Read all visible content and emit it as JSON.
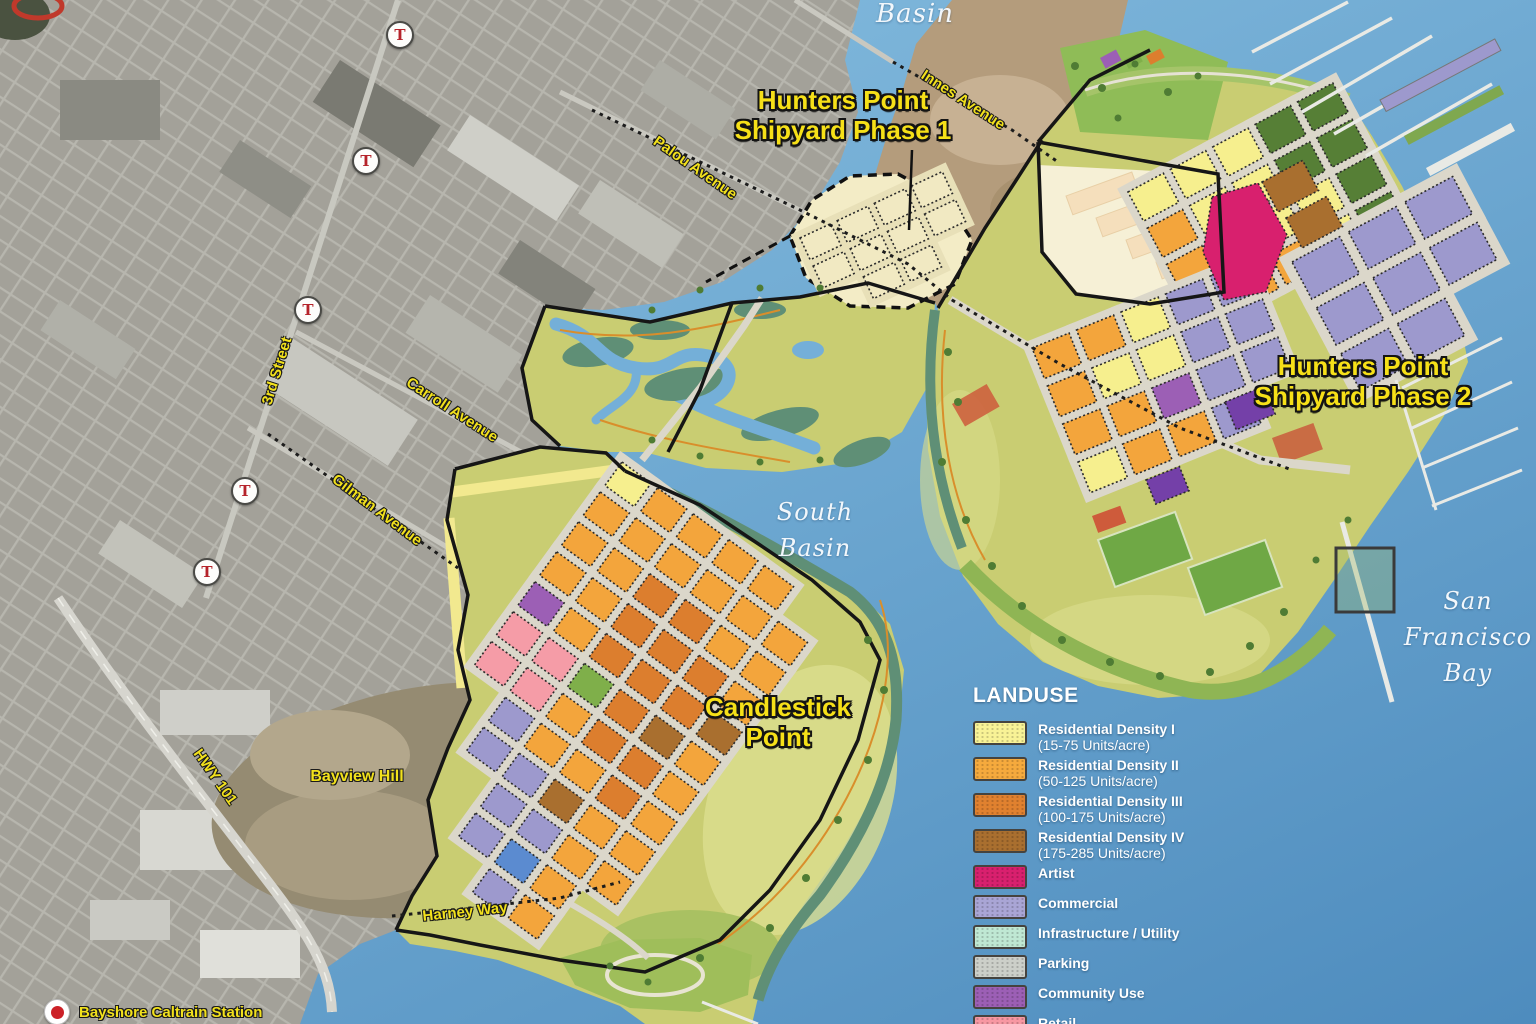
{
  "map": {
    "region_titles": {
      "phase1_line1": "Hunters Point",
      "phase1_line2": "Shipyard Phase 1",
      "phase2_line1": "Hunters Point",
      "phase2_line2": "Shipyard Phase 2",
      "candlestick_line1": "Candlestick",
      "candlestick_line2": "Point"
    },
    "water_labels": {
      "basin_top": "Basin",
      "south_basin_line1": "South",
      "south_basin_line2": "Basin",
      "sf_bay_line1": "San",
      "sf_bay_line2": "Francisco",
      "sf_bay_line3": "Bay"
    },
    "street_labels": {
      "innes": "Innes Avenue",
      "palou": "Palou Avenue",
      "carroll": "Carroll Avenue",
      "third": "3rd Street",
      "gilman": "Gilman Avenue",
      "hwy101": "HWY 101",
      "harney": "Harney Way"
    },
    "place_labels": {
      "bayview_hill": "Bayview Hill",
      "bayshore_station": "Bayshore Caltrain Station"
    },
    "transit_marker_letter": "T"
  },
  "legend": {
    "title": "LANDUSE",
    "items": [
      {
        "label": "Residential Density I",
        "sublabel": "(15-75 Units/acre)",
        "color": "#F8F296"
      },
      {
        "label": "Residential Density II",
        "sublabel": "(50-125 Units/acre)",
        "color": "#F5AA3D"
      },
      {
        "label": "Residential Density III",
        "sublabel": "(100-175 Units/acre)",
        "color": "#E0812F"
      },
      {
        "label": "Residential Density IV",
        "sublabel": "(175-285 Units/acre)",
        "color": "#A96F2F"
      },
      {
        "label": "Artist",
        "color": "#D8206E"
      },
      {
        "label": "Commercial",
        "color": "#A9A5D5"
      },
      {
        "label": "Infrastructure / Utility",
        "color": "#BFE8D3"
      },
      {
        "label": "Parking",
        "color": "#CCCFC9"
      },
      {
        "label": "Community Use",
        "color": "#9C5FB5"
      },
      {
        "label": "Retail",
        "color": "#F797A2"
      },
      {
        "label": "",
        "color": "#6B74B8"
      }
    ]
  },
  "colors": {
    "water1": "#8AC1E2",
    "water2": "#4E8CBE",
    "satellite": "#A3A199",
    "satellite_line": "#CBCAC2",
    "dirt": "#B49C7C",
    "park": "#C9CD72",
    "park_light": "#DADD8C",
    "lawn": "#8FBC57",
    "marsh": "#5F8F76",
    "channel": "#74AFD8",
    "road": "#DBD7CA",
    "boundary": "#161616",
    "cream": "#F6F0D6",
    "peach": "#F5DFBC",
    "title_yellow": "#F6E018",
    "label_yellow": "#F2E11C",
    "pier": "#E9EAE5",
    "track_red": "#C0392B",
    "marker_red": "#CC2128"
  },
  "road_color": "#DBD7CA",
  "palette": {
    "Y": "#F6EF8E",
    "O": "#F3A53C",
    "D": "#DC7E2E",
    "B": "#A96F2F",
    "C": "#9D99CD",
    "U": "#9C5FB5",
    "R": "#F59CA7",
    "G": "#7FAF4A",
    "H": "#567F36",
    "L": "#5B8BD0",
    "T": "#F1E9C2"
  },
  "grids": [
    {
      "name": "phase2-top",
      "origin": [
        1128,
        192
      ],
      "rotate": -28,
      "cell": [
        40,
        33
      ],
      "gap": 8,
      "rows": [
        "YYYHH",
        "OYYHH",
        "OOYYH",
        "OOOYH"
      ]
    },
    {
      "name": "phase2-southeast",
      "origin": [
        1292,
        262
      ],
      "rotate": -28,
      "cell": [
        54,
        42
      ],
      "gap": 10,
      "rows": [
        "CCC",
        "CCC",
        "CC."
      ]
    },
    {
      "name": "phase2-mid",
      "origin": [
        1032,
        348
      ],
      "rotate": -22,
      "cell": [
        40,
        33
      ],
      "gap": 8,
      "rows": [
        "OOYCC",
        "OYYCC",
        "OOUCC",
        "YOOC."
      ]
    },
    {
      "name": "candlestick",
      "origin": [
        622,
        462
      ],
      "rotate": 36,
      "cell": [
        36,
        29
      ],
      "gap": 8,
      "rows": [
        "YOOOO.",
        "OOOOOO",
        "OODDOO",
        "OODDDO",
        "UODDDB",
        "RRGDBO",
        "RRODDO",
        ".COODO",
        ".CCBOO",
        "..CCOO",
        "..CLO.",
        "...CO."
      ]
    },
    {
      "name": "phase1",
      "origin": [
        800,
        238
      ],
      "rotate": -25,
      "cell": [
        34,
        24
      ],
      "gap": 7,
      "road": "#E8E0B8",
      "rows": [
        "TTTT",
        "TTTT",
        ".TT."
      ]
    }
  ]
}
